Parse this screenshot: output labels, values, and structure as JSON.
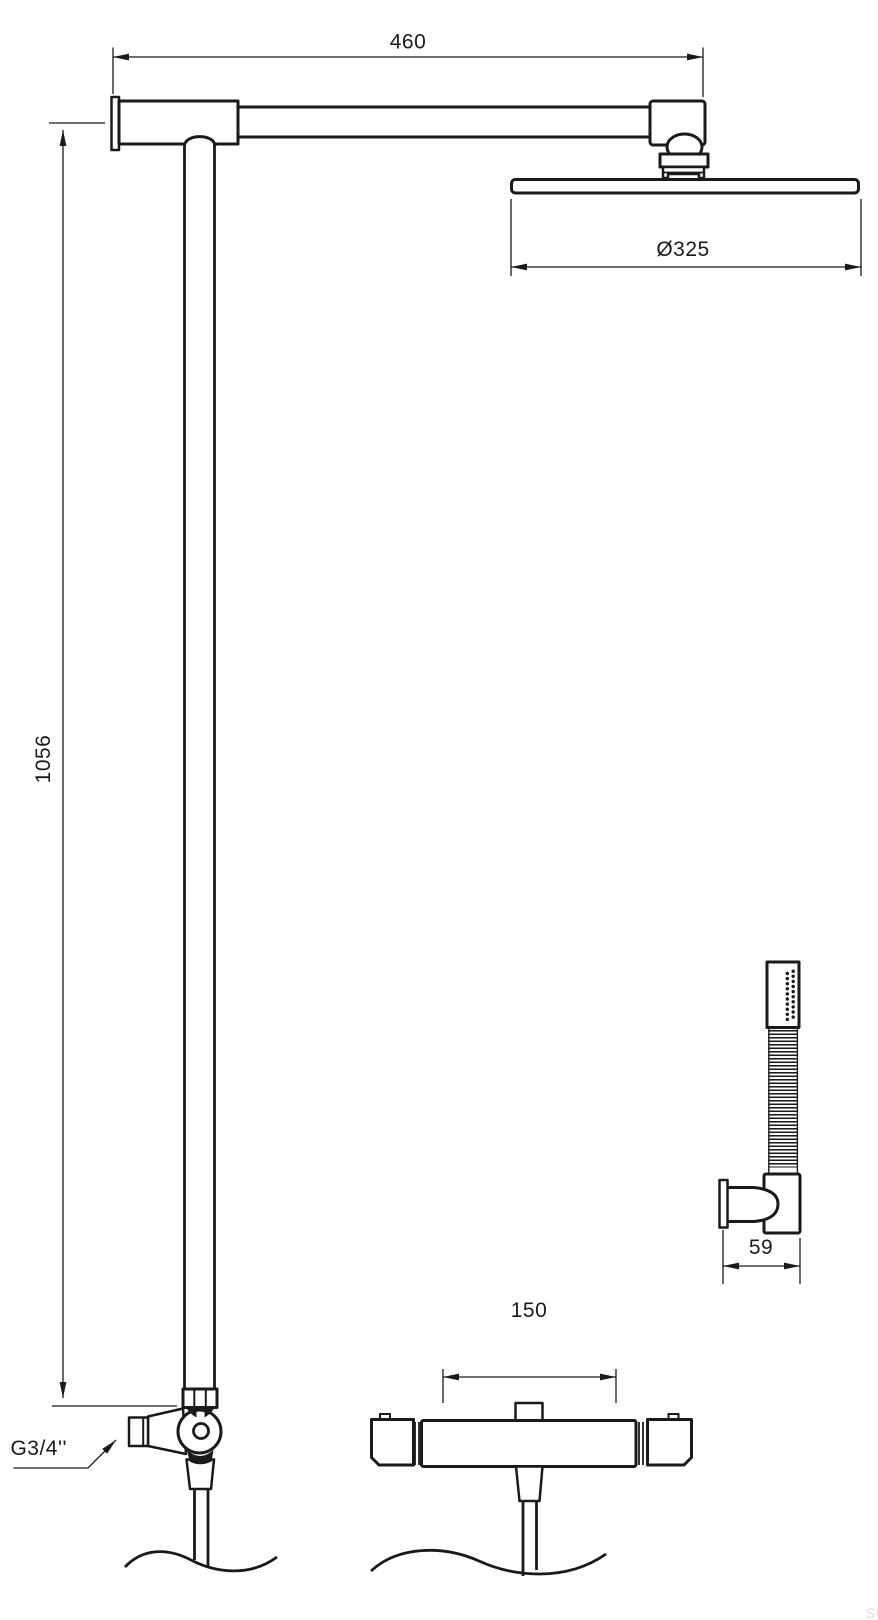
{
  "drawing": {
    "type": "technical-dimension-drawing",
    "subject": "shower-column-set-with-rain-head-hand-shower-and-thermostatic-mixer",
    "line_color": "#1a1a1a",
    "background_color": "#ffffff",
    "dimensions": {
      "arm_length": "460",
      "head_diameter": "Ø325",
      "column_height": "1056",
      "holder_depth": "59",
      "mixer_spacing": "150",
      "inlet_thread": "G3/4''"
    },
    "watermark": {
      "text": "SU",
      "color": "#dadada"
    }
  }
}
